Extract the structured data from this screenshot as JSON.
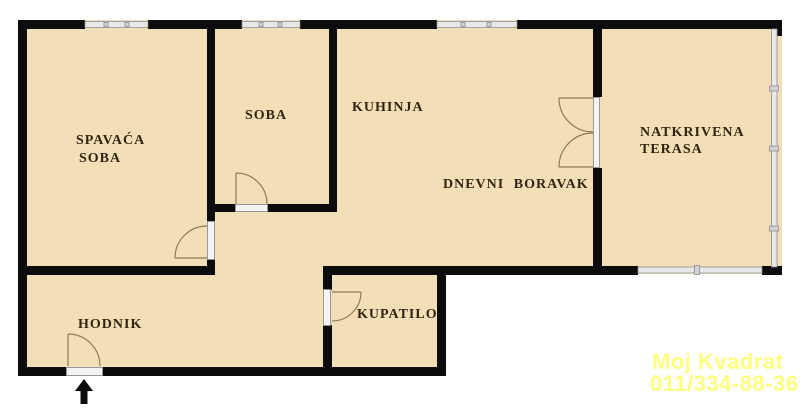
{
  "document": {
    "kind": "apartment-floor-plan",
    "language": "Serbian"
  },
  "palette": {
    "background": "#ffffff",
    "floor_fill": "#f2deb7",
    "wall_color": "#0c0c0c",
    "label_color": "#33240f",
    "window_fill": "#e8e8e8",
    "window_stroke": "#8f8f8f",
    "sill_fill": "#f4f4f4",
    "door_line_color": "#8d7b59",
    "watermark_color": "#ffff00"
  },
  "labels": {
    "spavaca_line1": "SPAVAĆA",
    "spavaca_line2": "SOBA",
    "soba": "SOBA",
    "kuhinja": "KUHINJA",
    "dnevni": "DNEVNI BORAVAK",
    "terasa_line1": "NATKRIVENA",
    "terasa_line2": "TERASA",
    "hodnik": "HODNIK",
    "kupatilo": "KUPATILO"
  },
  "rooms": [
    {
      "id": "spavaca-soba",
      "name": "SPAVAĆA SOBA"
    },
    {
      "id": "soba",
      "name": "SOBA"
    },
    {
      "id": "kuhinja",
      "name": "KUHINJA"
    },
    {
      "id": "dnevni-boravak",
      "name": "DNEVNI BORAVAK"
    },
    {
      "id": "natkrivena-terasa",
      "name": "NATKRIVENA TERASA"
    },
    {
      "id": "hodnik",
      "name": "HODNIK"
    },
    {
      "id": "kupatilo",
      "name": "KUPATILO"
    }
  ],
  "features": {
    "doors": [
      {
        "id": "bedroom-door",
        "opens_into": "SPAVAĆA SOBA"
      },
      {
        "id": "small-room-door",
        "opens_into": "SOBA"
      },
      {
        "id": "terrace-double-door",
        "opens_into": "DNEVNI BORAVAK"
      },
      {
        "id": "bathroom-door",
        "opens_into": "KUPATILO"
      },
      {
        "id": "entrance-door",
        "opens_into": "HODNIK"
      }
    ],
    "windows": [
      "bedroom-window",
      "small-room-window",
      "kitchen-window",
      "terrace-side-glazing",
      "terrace-front-railing"
    ],
    "entrance_marker": "up-arrow"
  },
  "watermark": {
    "line1": "Moj Kvadrat",
    "line2": "011/334-88-36"
  }
}
